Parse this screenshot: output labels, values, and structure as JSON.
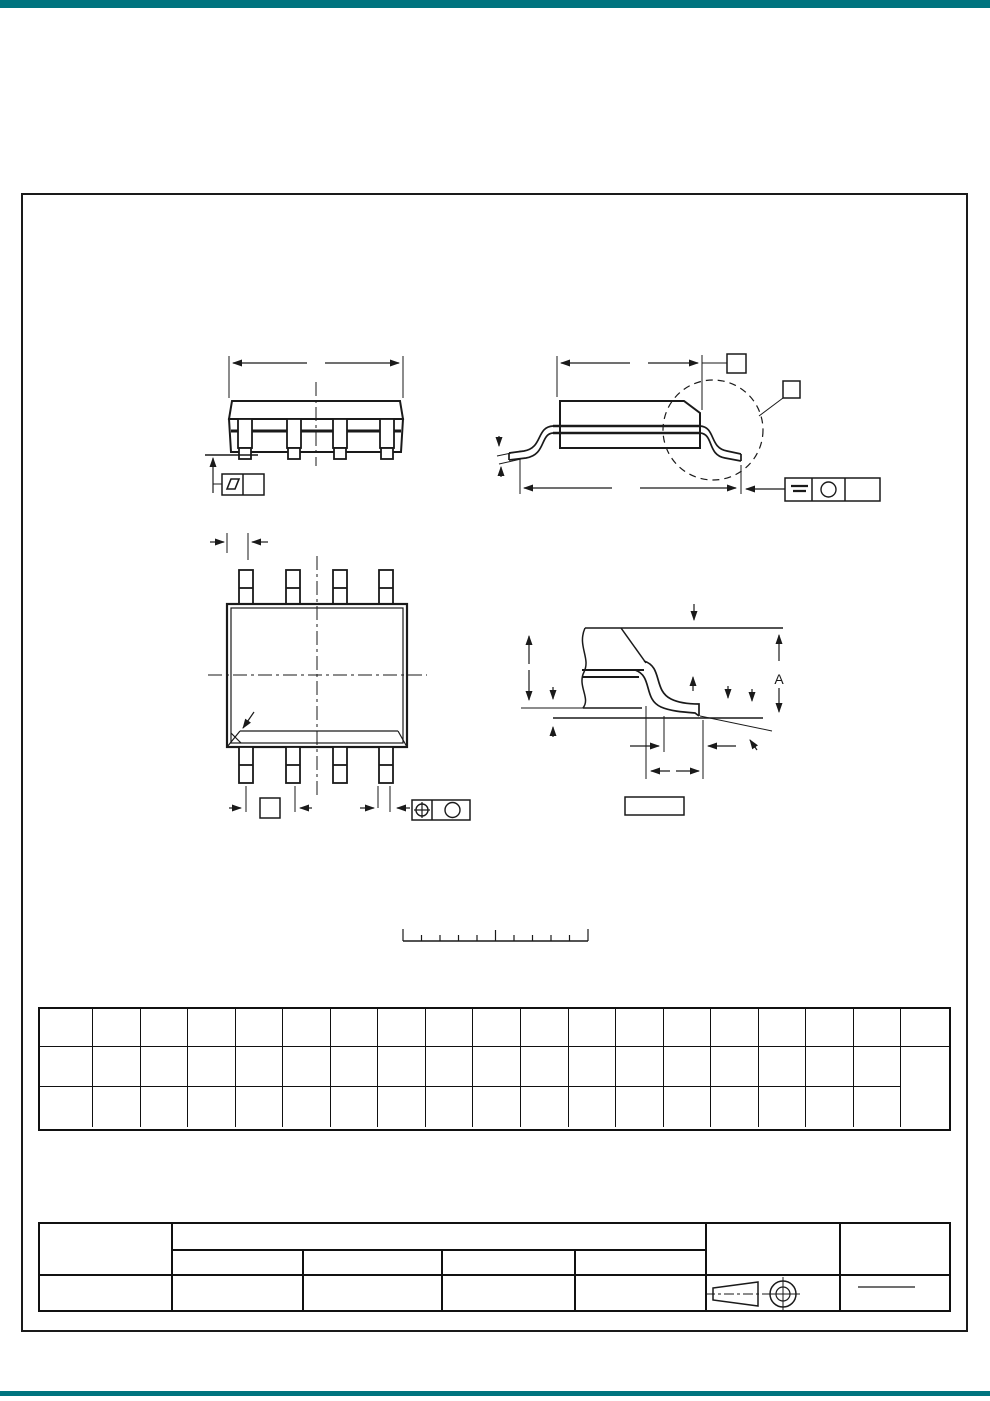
{
  "page": {
    "background": "#ffffff",
    "accent_color": "#00747f",
    "line_color": "#1a1a1a"
  },
  "drawing": {
    "views": {
      "front_view": "package-front-view",
      "side_view": "package-side-view",
      "top_view": "package-top-view",
      "lead_detail": "lead-detail-view"
    },
    "lead_detail": {
      "dim_label": "A"
    },
    "symbols": {
      "flatness": "parallelogram-icon",
      "seating_plane": "double-bar-icon",
      "position": "circle-crosshair-icon",
      "material_modifier": "circle-icon",
      "note_flag": "square-box-icon",
      "detail_balloon": "dashed-circle-icon",
      "projection": "third-angle-projection-icon"
    }
  },
  "scale_ruler": {
    "divisions": 10
  },
  "dim_table": {
    "merged_last_column": true,
    "rows": [
      [
        "",
        "",
        "",
        "",
        "",
        "",
        "",
        "",
        "",
        "",
        "",
        "",
        "",
        "",
        "",
        "",
        "",
        "",
        ""
      ],
      [
        "",
        "",
        "",
        "",
        "",
        "",
        "",
        "",
        "",
        "",
        "",
        "",
        "",
        "",
        "",
        "",
        "",
        "",
        ""
      ],
      [
        "",
        "",
        "",
        "",
        "",
        "",
        "",
        "",
        "",
        "",
        "",
        "",
        "",
        "",
        "",
        "",
        "",
        ""
      ]
    ]
  },
  "title_block": {
    "left_cell": "",
    "top_wide_cell": "",
    "sub_cells": [
      "",
      "",
      "",
      ""
    ],
    "right_cell_1": "",
    "right_cell_2": "",
    "bottom_cells": [
      "",
      "",
      "",
      "",
      ""
    ],
    "scale_fraction_text": ""
  }
}
